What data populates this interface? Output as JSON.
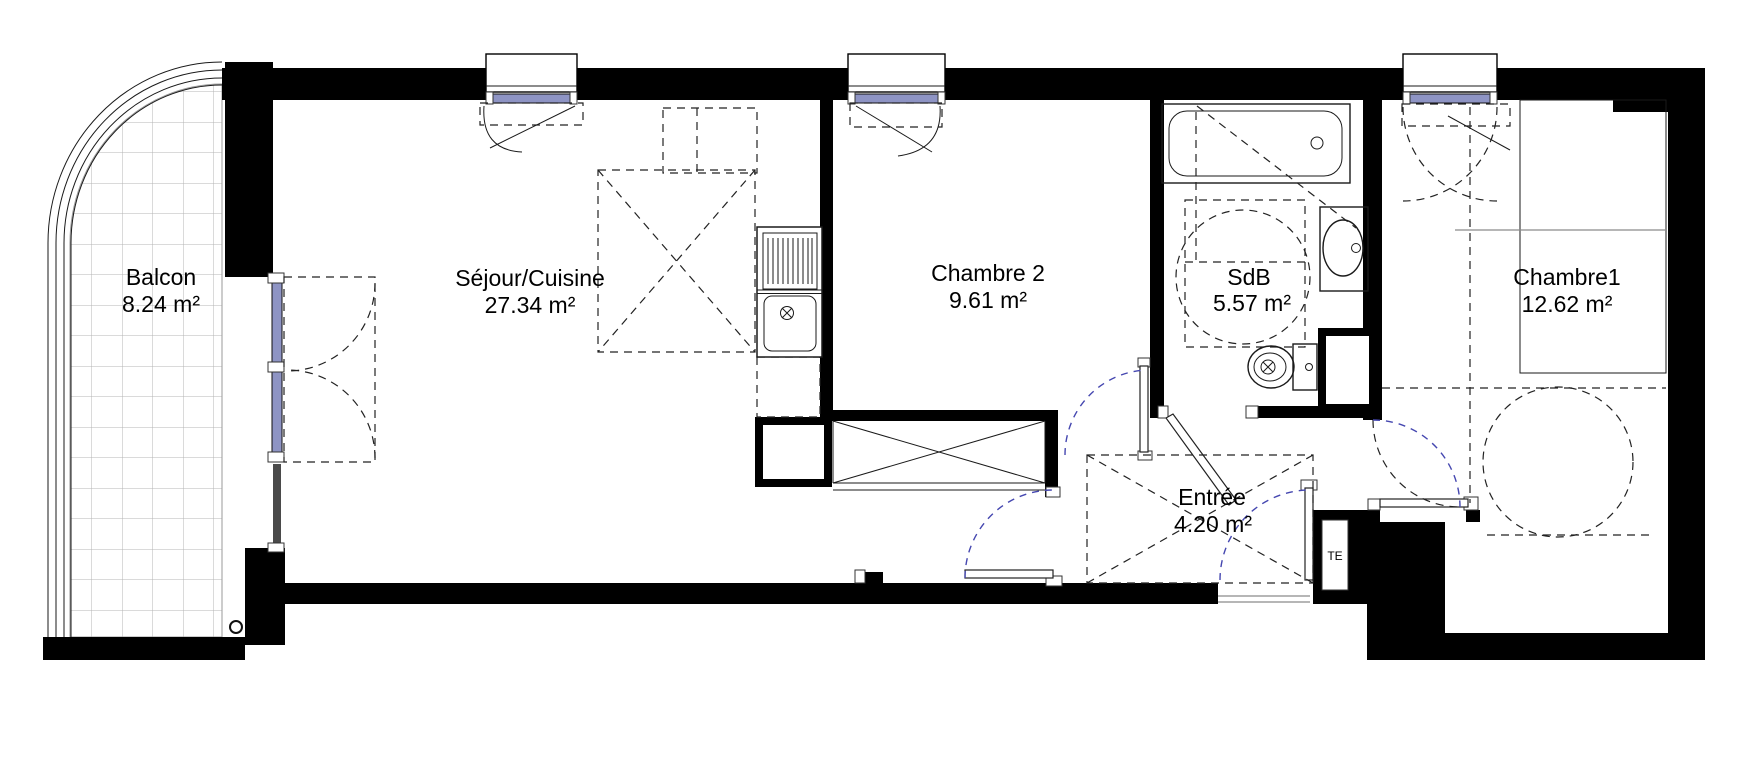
{
  "plan": {
    "type": "apartment-floor-plan",
    "rooms": {
      "balcon": {
        "name": "Balcon",
        "area": "8.24 m²"
      },
      "sejour": {
        "name": "Séjour/Cuisine",
        "area": "27.34 m²"
      },
      "chambre2": {
        "name": "Chambre 2",
        "area": "9.61 m²"
      },
      "sdb": {
        "name": "SdB",
        "area": "5.57 m²"
      },
      "entree": {
        "name": "Entrée",
        "area": "4.20 m²"
      },
      "chambre1": {
        "name": "Chambre1",
        "area": "12.62 m²"
      }
    },
    "panels": {
      "te_label": "TE"
    },
    "colors": {
      "wall": "#000000",
      "glazing_blue": "#8e94c4",
      "swing_arc_blue": "#4547b0",
      "tile_line": "#b4b4b4",
      "fixture_line": "#1a1a1a"
    }
  }
}
